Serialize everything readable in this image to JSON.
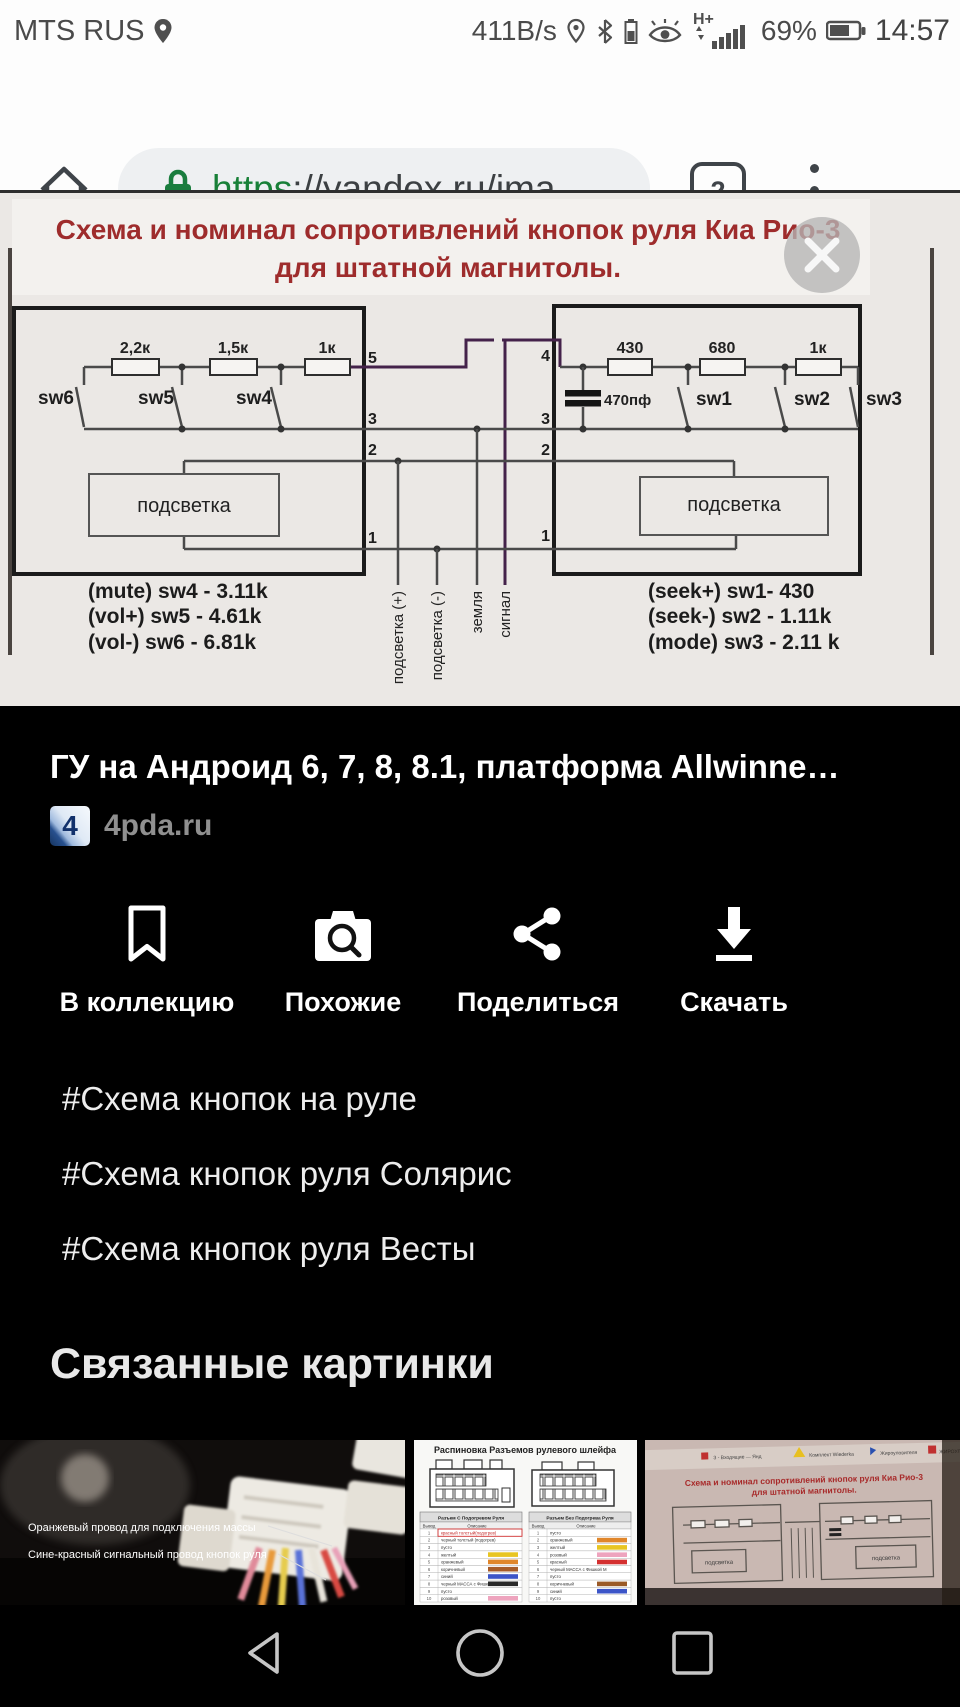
{
  "colors": {
    "url_https_green": "#188038",
    "lock_green": "#1a7d3e",
    "schematic_title_red": "#9e2c2c",
    "signal_wire_purple": "#44224a"
  },
  "status_bar": {
    "carrier": "MTS RUS",
    "net_speed": "411B/s",
    "network_type": "H+",
    "battery_percent": "69%",
    "time": "14:57"
  },
  "browser_bar": {
    "url_scheme": "https",
    "url_rest": "://yandex.ru/ima",
    "tab_count": "2"
  },
  "schematic": {
    "title_line1": "Схема и номинал сопротивлений кнопок руля Киа Рио-3",
    "title_line2": "для штатной магнитолы.",
    "left_block": {
      "resistors": [
        "2,2к",
        "1,5к",
        "1к"
      ],
      "switch_labels": [
        "sw6",
        "sw5",
        "sw4"
      ],
      "pins": [
        "5",
        "3",
        "2",
        "1"
      ],
      "backlight": "подсветка",
      "values": [
        "(mute) sw4 - 3.11k",
        "(vol+) sw5 - 4.61k",
        "(vol-) sw6 - 6.81k"
      ]
    },
    "right_block": {
      "resistors": [
        "430",
        "680",
        "1к"
      ],
      "switch_labels": [
        "sw1",
        "sw2",
        "sw3"
      ],
      "pins": [
        "4",
        "3",
        "2",
        "1"
      ],
      "capacitor": "470пф",
      "backlight": "подсветка",
      "values": [
        "(seek+) sw1- 430",
        "(seek-) sw2 - 1.11k",
        "(mode) sw3 - 2.11 k"
      ]
    },
    "wire_labels": [
      "подсветка (+)",
      "подсветка (-)",
      "земля",
      "сигнал"
    ]
  },
  "result": {
    "title": "ГУ на Андроид 6, 7, 8, 8.1, платформа Allwinne…",
    "favicon_letter": "4",
    "source": "4pda.ru"
  },
  "actions": {
    "collection": "В коллекцию",
    "similar": "Похожие",
    "share": "Поделиться",
    "download": "Скачать"
  },
  "hashtags": [
    "#Схема кнопок на руле",
    "#Схема кнопок руля Солярис",
    "#Схема кнопок руля Весты"
  ],
  "related": {
    "heading": "Связанные картинки",
    "thumb1": {
      "label1": "Оранжевый провод для подключения массы",
      "label2": "Сине-красный сигнальный провод  кнопок руля"
    },
    "thumb2": {
      "title": "Распиновка Разъемов рулевого шлейфа",
      "table_left_header": "Разъем С Подогревом Руля",
      "table_right_header": "Разъем Без Подогрева Руля",
      "col_pin": "Вывод",
      "col_desc": "Описание",
      "row_numbers": [
        "1",
        "2",
        "3",
        "4",
        "5",
        "6",
        "7",
        "8",
        "9",
        "10"
      ],
      "rows_left": [
        "красный толстый(подогрев)",
        "черный толстый (подогрев)",
        "пусто",
        "желтый",
        "оранжевый",
        "коричневый",
        "синий",
        "черный МАССА с Фишкой В",
        "пусто",
        "розовый"
      ],
      "rows_right": [
        "пусто",
        "оранжевый",
        "желтый",
        "розовый",
        "красный",
        "черный МАССА с Фишкой М",
        "пусто",
        "коричневый",
        "синий",
        "пусто"
      ]
    },
    "thumb3": {
      "title_line1": "Схема и номинал сопротивлений кнопок руля Киа Рио-3",
      "title_line2": "для штатной магнитолы.",
      "backlight": "подсветка",
      "top_snippets": [
        "З - Входящие — Янд",
        "Комплект Wiederka",
        "Жироуловителя",
        "ЖИРОУЛОВИТЕЛ"
      ]
    }
  }
}
